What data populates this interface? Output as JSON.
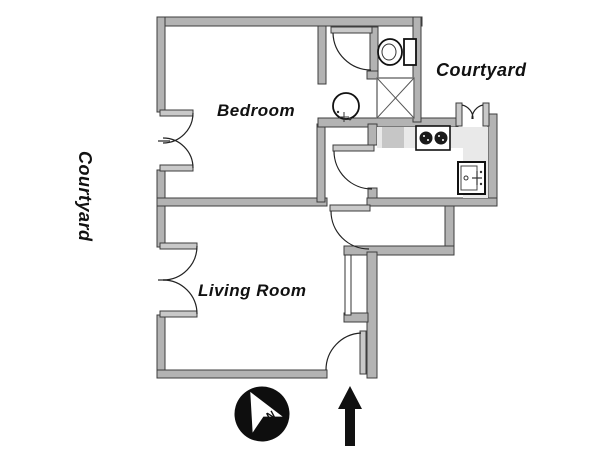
{
  "floorplan": {
    "rooms": [
      {
        "name": "Bedroom"
      },
      {
        "name": "Living Room"
      }
    ],
    "outdoor_labels": [
      {
        "name": "Courtyard",
        "position": "left-rotated"
      },
      {
        "name": "Courtyard",
        "position": "upper-right"
      }
    ],
    "compass": {
      "letter": "N"
    },
    "fixtures": [
      "toilet",
      "shower",
      "washbasin",
      "stove-burners",
      "kitchen-sink"
    ],
    "colors": {
      "wall_fill": "#b3b3b3",
      "wall_outline": "#3d3d3d",
      "counter_light": "#e9e9e9",
      "appliance_gray": "#c6c6c6",
      "symbol_black": "#111111"
    }
  }
}
